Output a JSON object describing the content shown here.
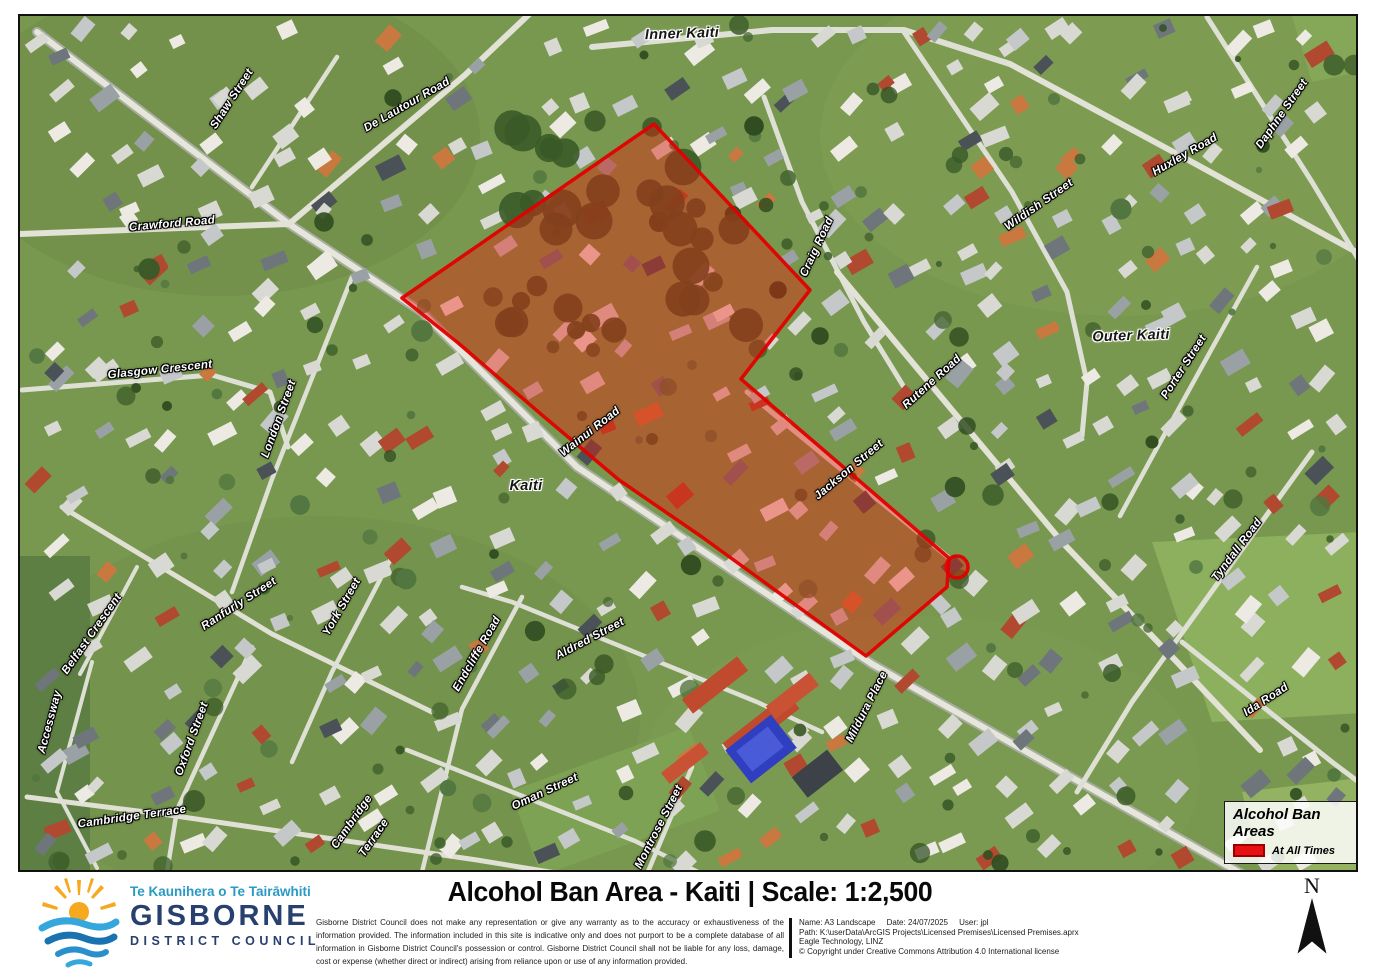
{
  "map": {
    "ban_area_color": "#e60000",
    "legend": {
      "title": "Alcohol Ban Areas",
      "items": [
        {
          "label": "At All Times",
          "color": "#e81010"
        }
      ]
    },
    "north_label": "N",
    "locality_labels": [
      {
        "text": "Inner Kaiti",
        "x": 662,
        "y": 18,
        "rot": -2
      },
      {
        "text": "Outer Kaiti",
        "x": 1111,
        "y": 320,
        "rot": -2
      },
      {
        "text": "Kaiti",
        "x": 506,
        "y": 470,
        "rot": 0
      }
    ],
    "street_labels": [
      {
        "text": "Shaw Street",
        "x": 212,
        "y": 83,
        "rot": -57
      },
      {
        "text": "De Lautour Road",
        "x": 387,
        "y": 89,
        "rot": -30
      },
      {
        "text": "Crawford Road",
        "x": 152,
        "y": 208,
        "rot": -5
      },
      {
        "text": "Glasgow Crescent",
        "x": 140,
        "y": 354,
        "rot": -6
      },
      {
        "text": "London Street",
        "x": 259,
        "y": 403,
        "rot": -70
      },
      {
        "text": "Wainui Road",
        "x": 570,
        "y": 416,
        "rot": -38
      },
      {
        "text": "Craig Road",
        "x": 797,
        "y": 231,
        "rot": -65
      },
      {
        "text": "Wildish Street",
        "x": 1019,
        "y": 189,
        "rot": -35
      },
      {
        "text": "Rutene Road",
        "x": 912,
        "y": 366,
        "rot": -42
      },
      {
        "text": "Huxley Road",
        "x": 1165,
        "y": 139,
        "rot": -30
      },
      {
        "text": "Daphne Street",
        "x": 1262,
        "y": 98,
        "rot": -55
      },
      {
        "text": "Porter Street",
        "x": 1164,
        "y": 351,
        "rot": -57
      },
      {
        "text": "Jackson Street",
        "x": 829,
        "y": 454,
        "rot": -40
      },
      {
        "text": "Tyndall Road",
        "x": 1217,
        "y": 534,
        "rot": -53
      },
      {
        "text": "Ida Road",
        "x": 1246,
        "y": 684,
        "rot": -33
      },
      {
        "text": "Mildura Place",
        "x": 847,
        "y": 691,
        "rot": -63
      },
      {
        "text": "Ranfurly Street",
        "x": 219,
        "y": 588,
        "rot": -33
      },
      {
        "text": "York Street",
        "x": 322,
        "y": 591,
        "rot": -60
      },
      {
        "text": "Belfast Crescent",
        "x": 72,
        "y": 618,
        "rot": -55
      },
      {
        "text": "Accessway",
        "x": 30,
        "y": 706,
        "rot": -75
      },
      {
        "text": "Oxford Street",
        "x": 172,
        "y": 723,
        "rot": -70
      },
      {
        "text": "Cambridge Terrace",
        "x": 112,
        "y": 801,
        "rot": -8
      },
      {
        "text": "Cambridge",
        "x": 332,
        "y": 806,
        "rot": -55
      },
      {
        "text": "Terrace",
        "x": 354,
        "y": 822,
        "rot": -55
      },
      {
        "text": "Endcliffe Road",
        "x": 457,
        "y": 638,
        "rot": -60
      },
      {
        "text": "Aldred Street",
        "x": 570,
        "y": 623,
        "rot": -28
      },
      {
        "text": "Oman Street",
        "x": 525,
        "y": 776,
        "rot": -25
      },
      {
        "text": "Montrose Street",
        "x": 639,
        "y": 811,
        "rot": -63
      }
    ]
  },
  "footer": {
    "logo": {
      "line1": "Te Kaunihera o Te Tairāwhiti",
      "line2": "GISBORNE",
      "line3": "DISTRICT COUNCIL"
    },
    "title": "Alcohol Ban Area - Kaiti | Scale: 1:2,500",
    "disclaimer": "Gisborne District Council does not make any representation or give any warranty as to the accuracy or exhaustiveness of the information provided. The information included in this site is indicative only and does not purport to be a complete database of all information in Gisborne District Council's possession or control. Gisborne District Council shall not be liable for any loss, damage, cost or expense (whether direct or indirect) arising from reliance upon or use of any information provided.",
    "metadata": {
      "line1": "Name: A3 Landscape     Date: 24/07/2025     User: jpl",
      "line2": "Path: K:\\userData\\ArcGIS Projects\\Licensed Premises\\Licensed Premises.aprx",
      "line3": "Eagle Technology, LINZ",
      "line4": "© Copyright under Creative Commons Attribution 4.0 International license"
    }
  }
}
